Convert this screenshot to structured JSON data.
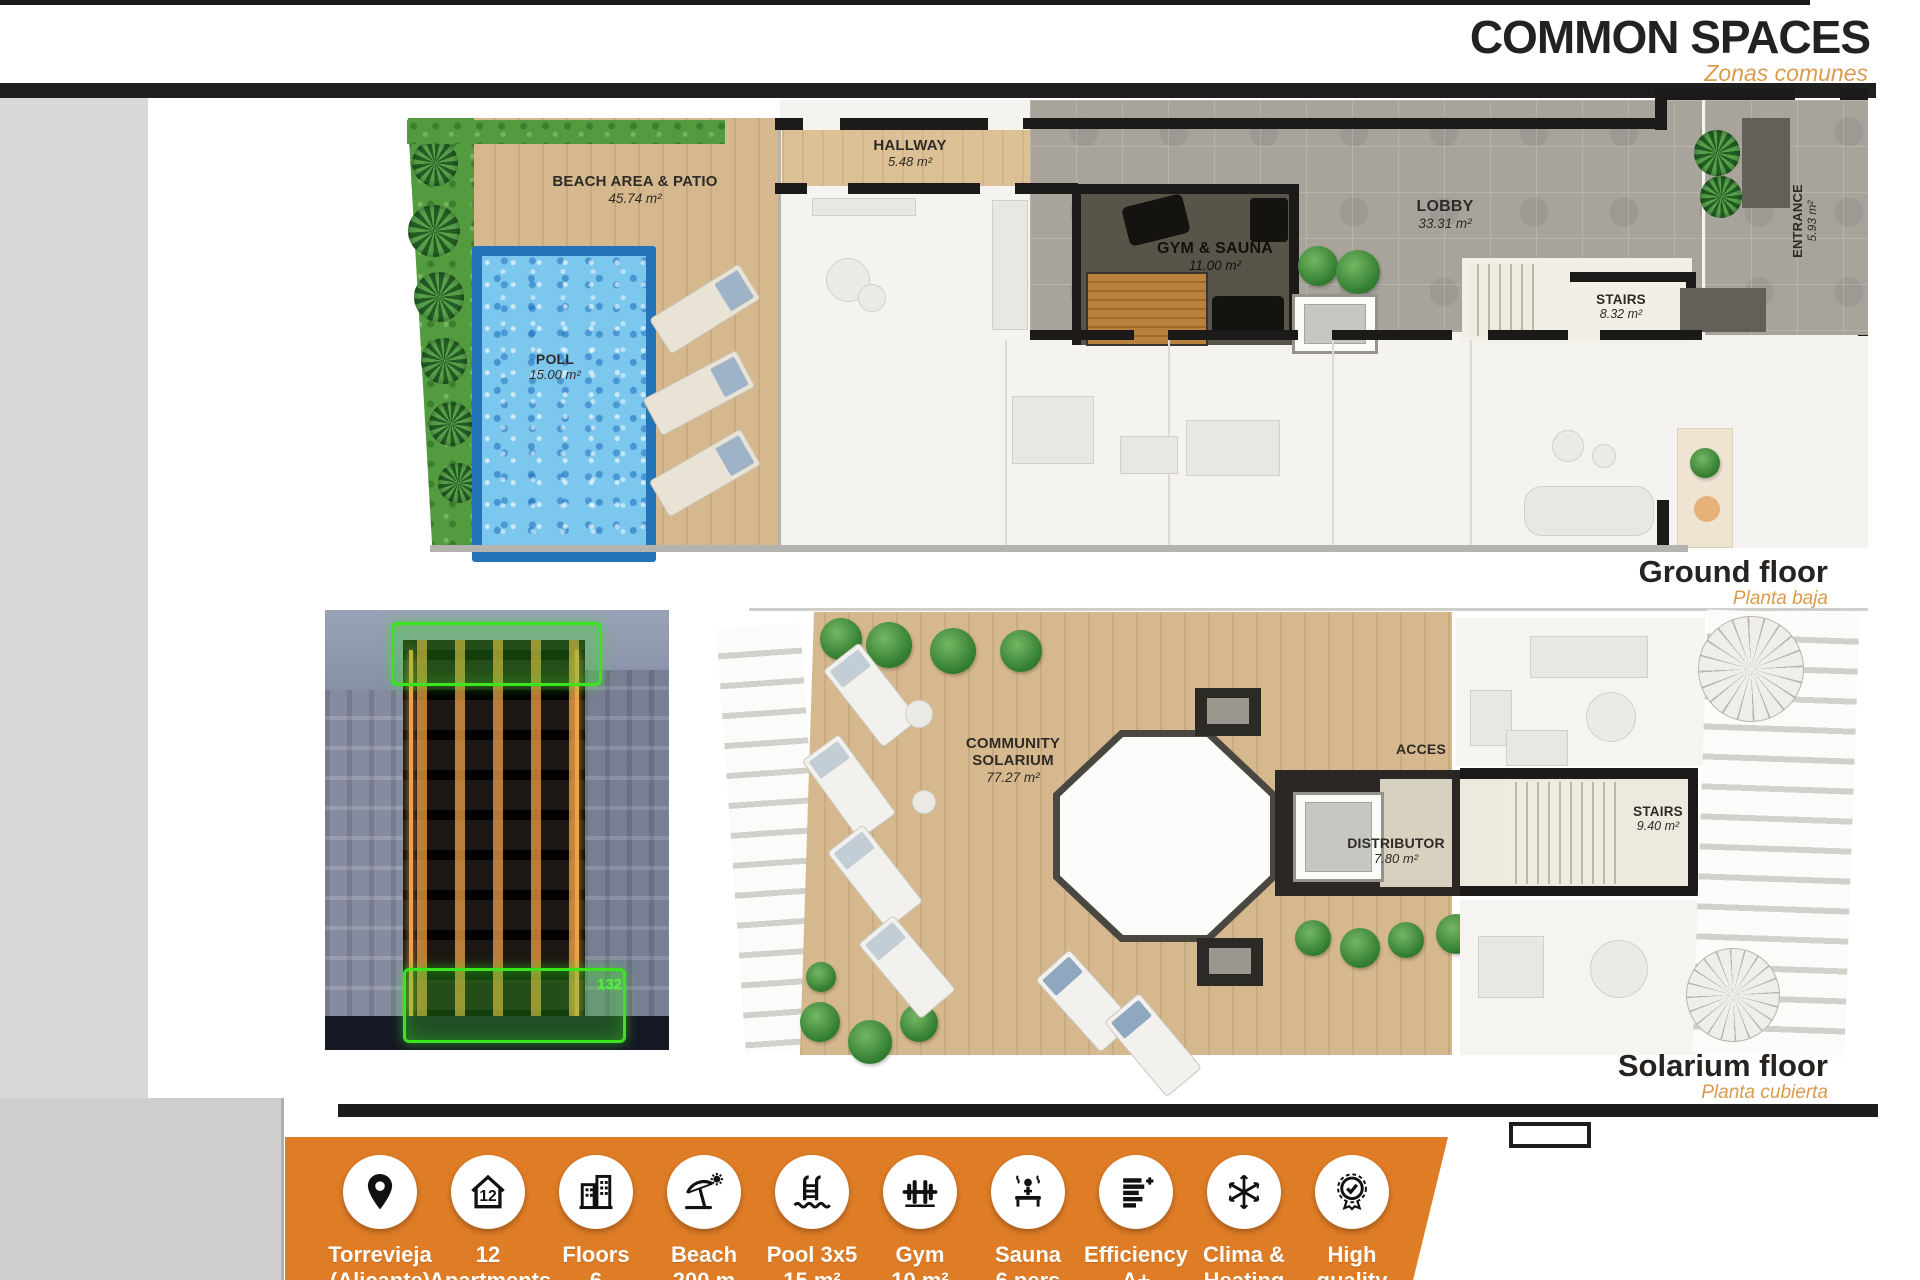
{
  "header": {
    "title": "COMMON SPACES",
    "subtitle": "Zonas comunes"
  },
  "ground_floor": {
    "caption": "Ground floor",
    "caption_sub": "Planta baja",
    "rooms": {
      "beach": {
        "name": "BEACH AREA & PATIO",
        "area": "45.74 m²"
      },
      "pool": {
        "name": "POLL",
        "area": "15.00 m²"
      },
      "hallway": {
        "name": "HALLWAY",
        "area": "5.48 m²"
      },
      "gym": {
        "name": "GYM & SAUNA",
        "area": "11.00 m²"
      },
      "lobby": {
        "name": "LOBBY",
        "area": "33.31 m²"
      },
      "stairs": {
        "name": "STAIRS",
        "area": "8.32 m²"
      },
      "entrance": {
        "name": "ENTRANCE",
        "area": "5.93 m²"
      }
    }
  },
  "solarium_floor": {
    "caption": "Solarium floor",
    "caption_sub": "Planta cubierta",
    "rooms": {
      "solarium": {
        "name": "COMMUNITY SOLARIUM",
        "area": "77.27 m²"
      },
      "acces": {
        "name": "ACCES"
      },
      "distributor": {
        "name": "DISTRIBUTOR",
        "area": "7.80 m²"
      },
      "stairs": {
        "name": "STAIRS",
        "area": "9.40 m²"
      }
    }
  },
  "photo": {
    "unit_number": "132"
  },
  "features": [
    {
      "icon": "location-pin-icon",
      "line1": "Torrevieja",
      "line2": "(Alicante)"
    },
    {
      "icon": "house-number-icon",
      "line1": "12",
      "line2": "Apartments"
    },
    {
      "icon": "building-floors-icon",
      "line1": "Floors",
      "line2": "6"
    },
    {
      "icon": "beach-umbrella-icon",
      "line1": "Beach",
      "line2": "200 m"
    },
    {
      "icon": "pool-ladder-icon",
      "line1": "Pool 3x5",
      "line2": "15 m²"
    },
    {
      "icon": "gym-barbell-icon",
      "line1": "Gym",
      "line2": "10 m²"
    },
    {
      "icon": "sauna-icon",
      "line1": "Sauna",
      "line2": "6 pers"
    },
    {
      "icon": "energy-efficiency-icon",
      "line1": "Efficiency",
      "line2": "A+"
    },
    {
      "icon": "climate-snowflake-icon",
      "line1": "Clima &",
      "line2": "Heating"
    },
    {
      "icon": "quality-medal-icon",
      "line1": "High",
      "line2": "quality"
    }
  ],
  "colors": {
    "accent_orange": "#DF7C26",
    "subtitle_orange": "#D99B4E",
    "highlight_green": "#3AE51E",
    "wall_black": "#1C1C1C"
  }
}
